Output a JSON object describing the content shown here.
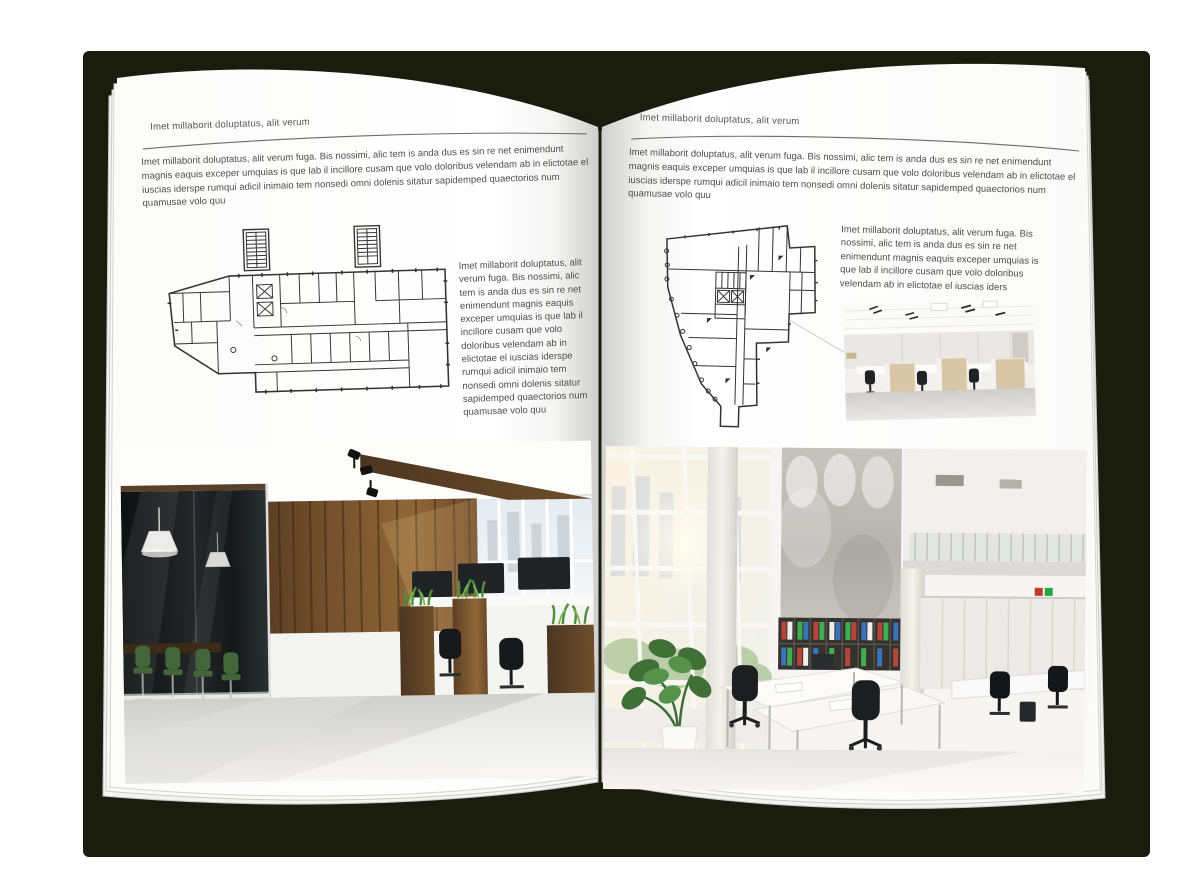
{
  "colors": {
    "backdrop": "#1a1c0e",
    "page": "#ffffff",
    "body_text": "#4e4e4e",
    "rule": "#6b6b6b",
    "plan_ink": "#333333",
    "wood_brown": "#75512f",
    "plant_green": "#4f8f3a",
    "binder_red": "#b5443b",
    "binder_green": "#3fae52",
    "binder_blue": "#3b72b8"
  },
  "left_page": {
    "header": "Imet millaborit doluptatus, alit verum",
    "intro": "Imet millaborit doluptatus, alit verum fuga. Bis nossimi, alic tem is anda dus es sin re net enimendunt magnis eaquis exceper umquias is que lab il incillore cusam que volo doloribus velendam ab in elictotae el iuscias iderspe rumqui adicil inimaio tem nonsedi omni dolenis sitatur sapidemped quaectorios num quamusae volo quu",
    "figure_text": "Imet millaborit doluptatus, alit verum fuga. Bis nossimi, alic tem is anda dus es sin re net enimendunt magnis eaquis exceper umquias is que lab il incillore cusam que volo doloribus velendam ab in elictotae el iuscias iderspe rumqui adicil inimaio tem nonsedi omni dolenis sitatur sapidemped quaectorios num quamusae volo quu"
  },
  "right_page": {
    "header": "Imet millaborit doluptatus, alit verum",
    "intro": "Imet millaborit doluptatus, alit verum fuga. Bis nossimi, alic tem is anda dus es sin re net enimendunt magnis eaquis exceper umquias is que lab il incillore cusam que volo doloribus velendam ab in elictotae el iuscias iderspe rumqui adicil inimaio tem nonsedi omni dolenis sitatur sapidemped quaectorios num quamusae volo quu",
    "figure_text": "Imet millaborit doluptatus, alit verum fuga. Bis nossimi, alic tem is anda dus es sin re net enimendunt magnis eaquis exceper umquias is que lab il incillore cusam que volo doloribus velendam ab in elictotae el iuscias iders"
  }
}
